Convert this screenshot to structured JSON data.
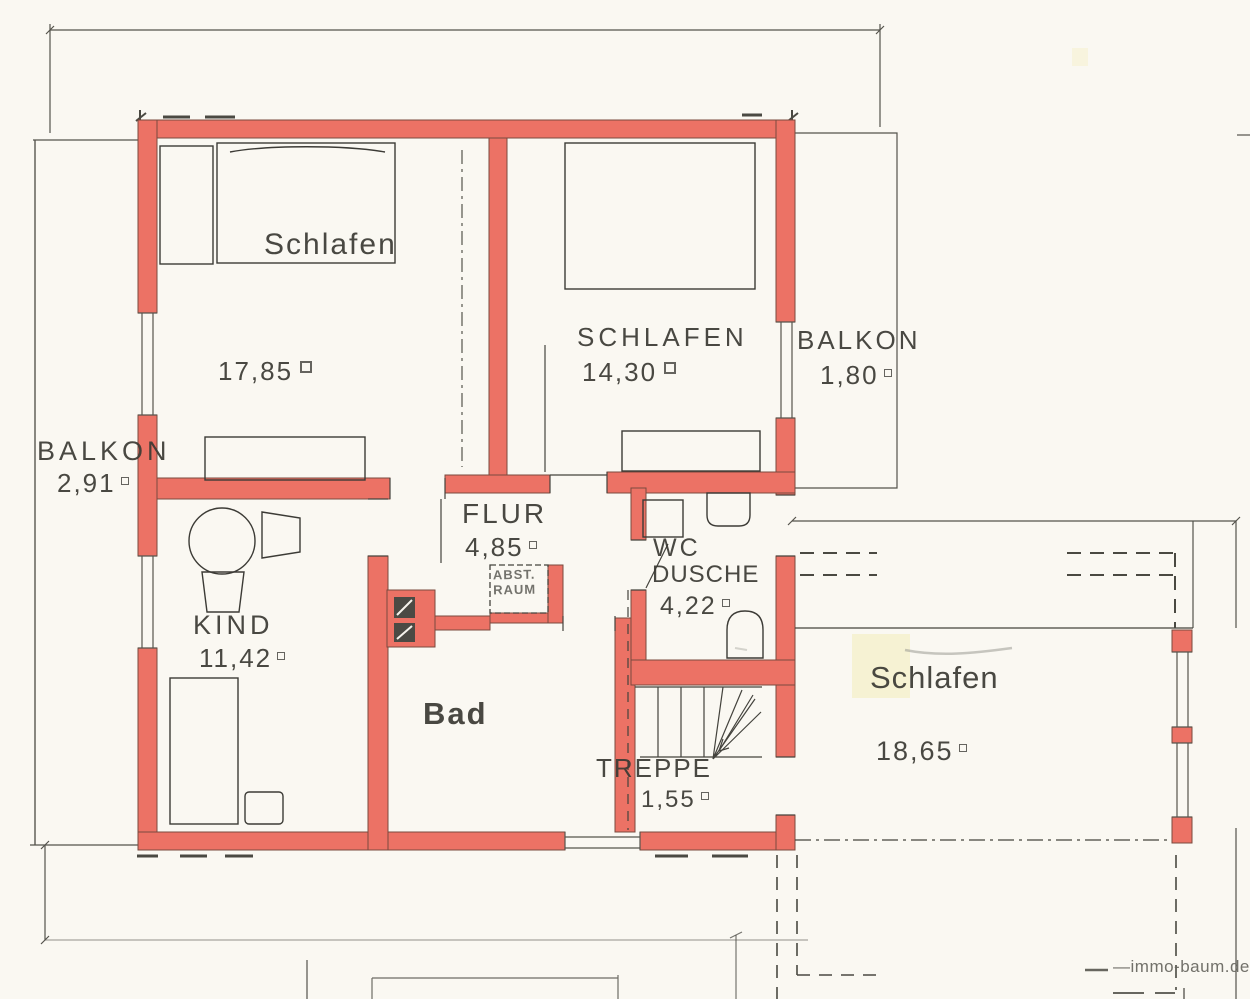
{
  "plan": {
    "rooms": {
      "schlafen_ul": {
        "name": "Schlafen",
        "area": "17,85",
        "unit": "m²"
      },
      "schlafen_ur": {
        "name": "SCHLAFEN",
        "area": "14,30",
        "unit": "m²"
      },
      "balkon_right": {
        "name": "BALKON",
        "area": "1,80",
        "unit": "m²"
      },
      "balkon_left": {
        "name": "BALKON",
        "area": "2,91",
        "unit": "m²"
      },
      "flur": {
        "name": "FLUR",
        "area": "4,85",
        "unit": "m²"
      },
      "abstellraum": {
        "line1": "ABST.",
        "line2": "RAUM"
      },
      "wc_dusche": {
        "line1": "WC",
        "line2": "DUSCHE",
        "area": "4,22",
        "unit": "m²"
      },
      "kind": {
        "name": "KIND",
        "area": "11,42",
        "unit": "m²"
      },
      "bad": {
        "name": "Bad"
      },
      "treppe": {
        "name": "TREPPE",
        "area": "1,55",
        "unit": "m²"
      },
      "schlafen_r": {
        "name": "Schlafen",
        "area": "18,65",
        "unit": "m²"
      }
    },
    "watermark": {
      "prefix": "—",
      "text": "immo-baum.de"
    },
    "colors": {
      "wall_fill": "#ec7265",
      "wall_edge": "#7a4a3e",
      "line": "#44433d",
      "background": "#faf8f2",
      "highlight": "#f3edba"
    }
  }
}
